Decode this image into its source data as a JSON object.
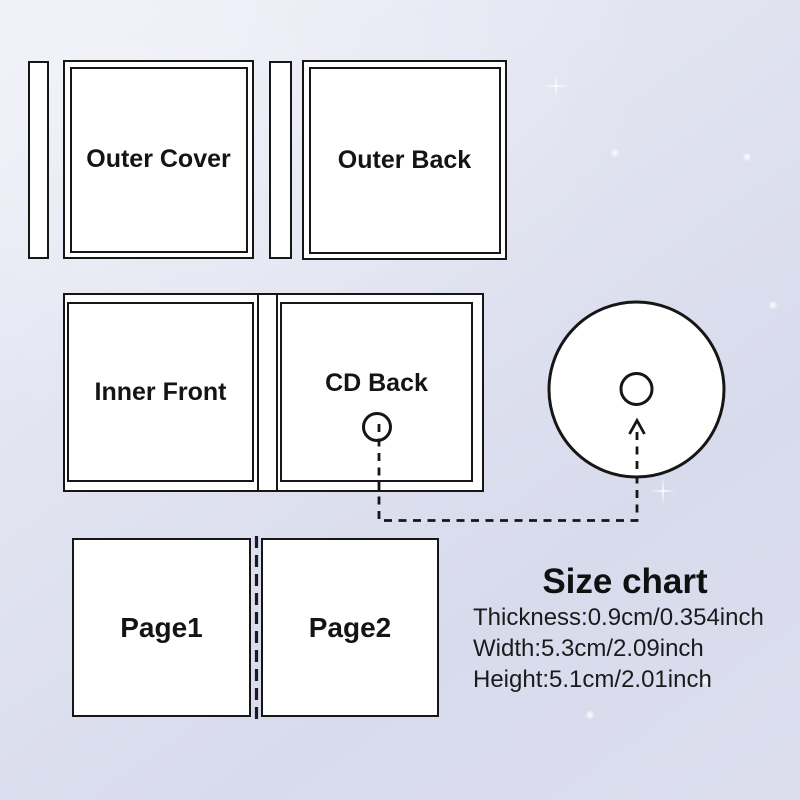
{
  "panels": {
    "outer_cover": {
      "label": "Outer Cover"
    },
    "outer_back": {
      "label": "Outer Back"
    },
    "inner_front": {
      "label": "Inner Front"
    },
    "cd_back": {
      "label": "CD Back"
    },
    "page1": {
      "label": "Page1"
    },
    "page2": {
      "label": "Page2"
    }
  },
  "size_chart": {
    "title": "Size chart",
    "thickness": "Thickness:0.9cm/0.354inch",
    "width": "Width:5.3cm/2.09inch",
    "height": "Height:5.1cm/2.01inch"
  },
  "icons": {
    "cd_disc": "white disc with center hole",
    "cd_back_hole": "small open circle (case hub)",
    "dashed_arrow": "dashed connector arrow from CD Back hub to disc",
    "fold_line": "dashed fold line between Page1 and Page2"
  },
  "colors": {
    "outline": "#161616",
    "panel_fill": "#ffffff",
    "background_light": "#eceef7",
    "background_dark": "#d8dbec",
    "text": "#141414"
  }
}
